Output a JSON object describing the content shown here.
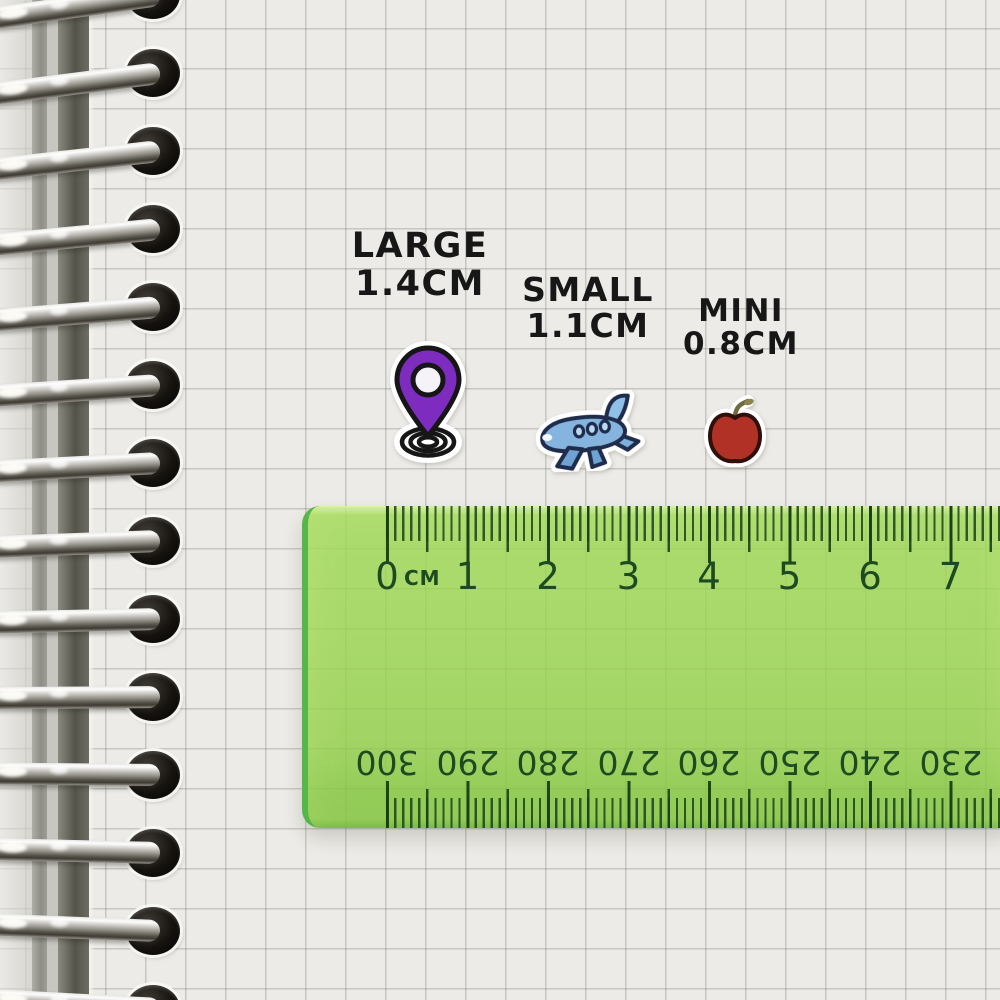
{
  "stickers": {
    "large": {
      "label": "LARGE",
      "size": "1.4CM",
      "icon": "location-pin-icon",
      "color": "#7e2cc0"
    },
    "small": {
      "label": "SMALL",
      "size": "1.1CM",
      "icon": "airplane-icon",
      "color": "#85b4de"
    },
    "mini": {
      "label": "MINI",
      "size": "0.8CM",
      "icon": "apple-icon",
      "color": "#b23126"
    }
  },
  "ruler": {
    "unit_label": "CM",
    "top_scale_labels": [
      "0",
      "1",
      "2",
      "3",
      "4",
      "5",
      "6",
      "7"
    ],
    "bottom_scale_labels": [
      "300",
      "290",
      "280",
      "270",
      "260",
      "250",
      "240",
      "230"
    ],
    "body_color": "#8ccf4a",
    "marking_color": "#1d4a20"
  },
  "notebook": {
    "ring_count": 14,
    "paper_color": "#ecebe7",
    "grid_color": "#c6c5c1",
    "ring_color": "#c9c7c2"
  }
}
